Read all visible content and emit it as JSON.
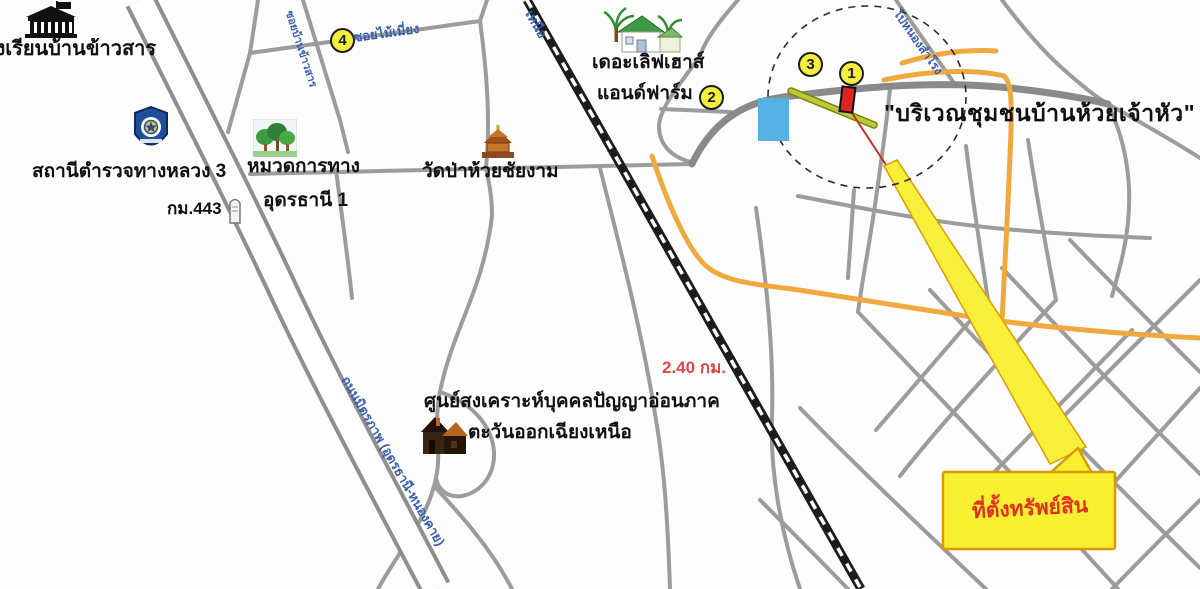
{
  "colors": {
    "road-gray": "#9c9c9c",
    "road-dark": "#8a8a8a",
    "highway-casing": "#8f8f8f",
    "railway-black": "#1c1c1c",
    "orange-road": "#f0a93e",
    "olive-road": "#bcc93a",
    "beam-yellow": "#f7ef3a",
    "box-yellow": "#f8ef30",
    "box-border": "#d89a00",
    "marker-red": "#dd2420",
    "badge-yellow": "#f4ef3c",
    "water-blue": "#56b2e4",
    "roadname-blue": "#3a5fb0",
    "distance-red": "#e04848",
    "property-red": "#e03222"
  },
  "labels": {
    "school": "โรงเรียนบ้านข้าวสาร",
    "police_station": "สถานีตำรวจทางหลวง 3",
    "km_marker": "กม.443",
    "highway_district_1": "หมวดการทาง",
    "highway_district_2": "อุดรธานี 1",
    "temple": "วัดป่าห้วยชัยงาม",
    "love_house_1": "เดอะเลิฟเฮาส์",
    "love_house_2": "แอนด์ฟาร์ม",
    "community_quote": "\"บริเวณชุมชนบ้านห้วยเจ้าหัว\"",
    "distance": "2.40 กม.",
    "welfare_center_1": "ศูนย์สงเคราะห์บุคคลปัญญาอ่อนภาค",
    "welfare_center_2": "ตะวันออกเฉียงเหนือ",
    "property_location": "ที่ตั้งทรัพย์สิน"
  },
  "road_names": {
    "soi_top": "ซอยไม้เมี่ยง",
    "soi_vertical": "ซอยบ้านข้าวสาร",
    "highway_name": "ถนนมิตรภาพ (อุดรธานี-หนองคาย)",
    "railway_north": "เหนือ",
    "road_ne": "ไปหนองสำโรง"
  },
  "markers": {
    "point1": "1",
    "point2": "2",
    "point3": "3",
    "point4": "4"
  }
}
